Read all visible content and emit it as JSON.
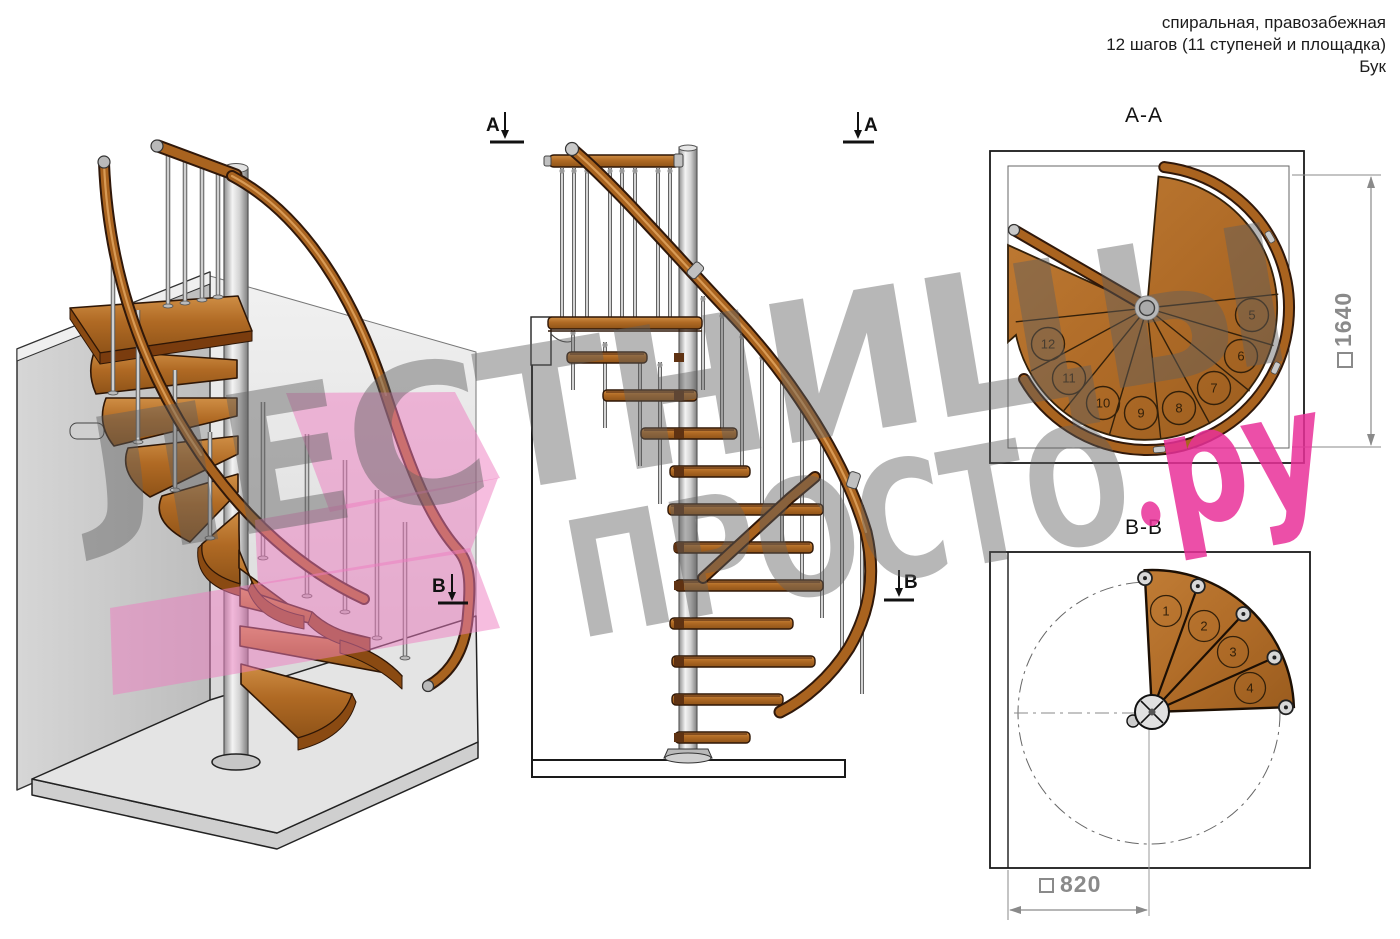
{
  "header": {
    "line1": "спиральная, правозабежная",
    "line2": "12 шагов (11 ступеней и площадка)",
    "line3": "Бук"
  },
  "watermark": {
    "word1": "ЛЕСТНИЦЫ",
    "word2": "ПРОСТО",
    "suffix": "ру"
  },
  "views": {
    "aa": {
      "title": "A-A",
      "dimension": "1640",
      "steps": [
        "5",
        "6",
        "7",
        "8",
        "9",
        "10",
        "11",
        "12"
      ]
    },
    "bb": {
      "title": "B-B",
      "dimension": "820",
      "steps": [
        "1",
        "2",
        "3",
        "4"
      ]
    },
    "markers": {
      "a": "A",
      "b": "B"
    }
  },
  "colors": {
    "wood": "#b5702a",
    "wood_dark": "#7a3c0e",
    "outline": "#2e1606",
    "steel": "#d9d9d9",
    "wall": "#c9c9c9",
    "accent_pink": "#e930a0",
    "dim_gray": "#8a8a8a"
  }
}
